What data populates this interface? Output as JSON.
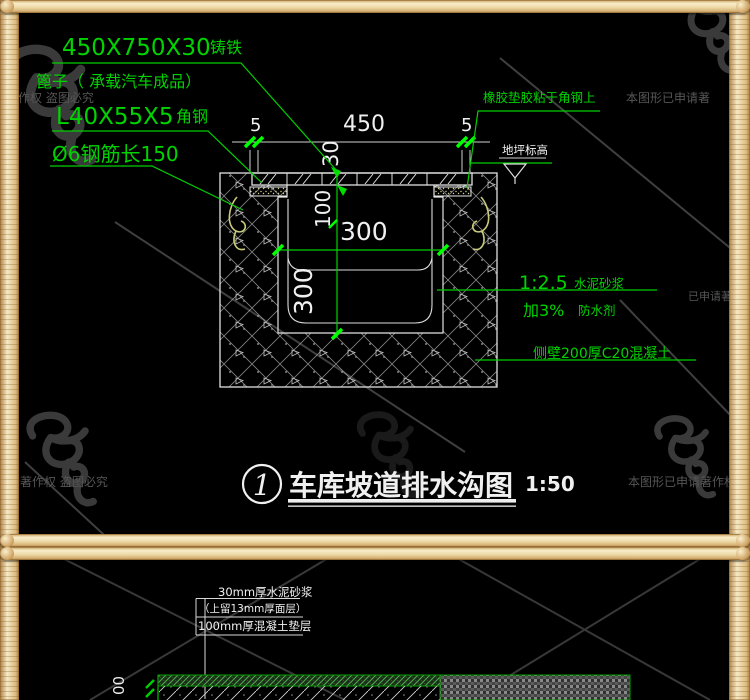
{
  "colors": {
    "cad_green": "#00d400",
    "cad_white": "#f0f0f0",
    "rebar_yellow": "#c9c97a",
    "frame_tan": "#ecd5a4",
    "watermark_gray": "#4a4a4a"
  },
  "watermark": {
    "full_text": "本图形已申请著作权 盗图必究",
    "frag_top_left": "作权 盗图必究",
    "frag_top_right": "本图形已申请著",
    "frag_bottom_left": "请著作权 盗图必究",
    "frag_bottom_right": "本图形已申请著作权",
    "frag_right_mid": "已申请著作"
  },
  "drawing1": {
    "callouts": {
      "grate_spec": "450X750X30",
      "grate_material": "铸铁",
      "grate_desc": "篦子（ 承载汽车成品）",
      "angle_spec": "L40X55X5",
      "angle_material": "角钢",
      "rebar_note": "Ø6钢筋长150",
      "rubber_note": "橡胶垫胶粘于角钢上",
      "floor_level": "地坪标高",
      "mortar_ratio": "1:2.5",
      "mortar_name": "水泥砂浆",
      "additive_amount": "加3%",
      "additive_name": "防水剂",
      "sidewall_note": "侧壁200厚C20混凝土"
    },
    "dims": {
      "gap_left": "5",
      "span": "450",
      "gap_right": "5",
      "grate_thickness": "30",
      "depth_top": "100",
      "width_inner": "300",
      "depth_inner": "300"
    },
    "title": {
      "number": "1",
      "name": "车库坡道排水沟图",
      "scale": "1:50"
    }
  },
  "drawing2": {
    "layers": [
      "30mm厚水泥砂浆",
      "（上留13mm厚面层）",
      "100mm厚混凝土垫层"
    ],
    "dim_left": "00"
  }
}
